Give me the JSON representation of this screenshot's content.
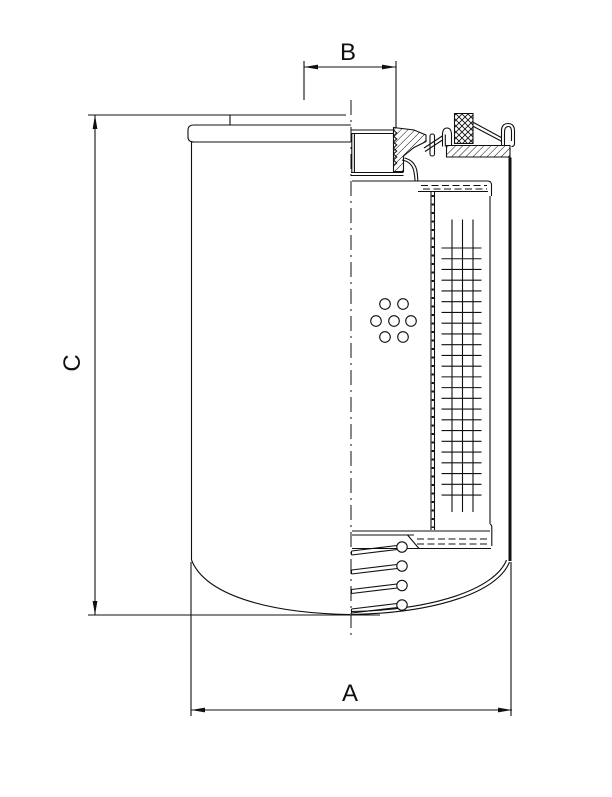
{
  "page": {
    "background": "#ffffff",
    "line_color": "#101010"
  },
  "labels": {
    "dim_a": "A",
    "dim_b": "B",
    "dim_c": "C"
  },
  "drawing": {
    "kind": "technical-section-drawing",
    "subject": "spin-on-filter-cartridge-half-section",
    "dimensioned_features": {
      "A": "overall-diameter-bottom",
      "B": "thread-diameter-top",
      "C": "overall-height-left"
    }
  }
}
